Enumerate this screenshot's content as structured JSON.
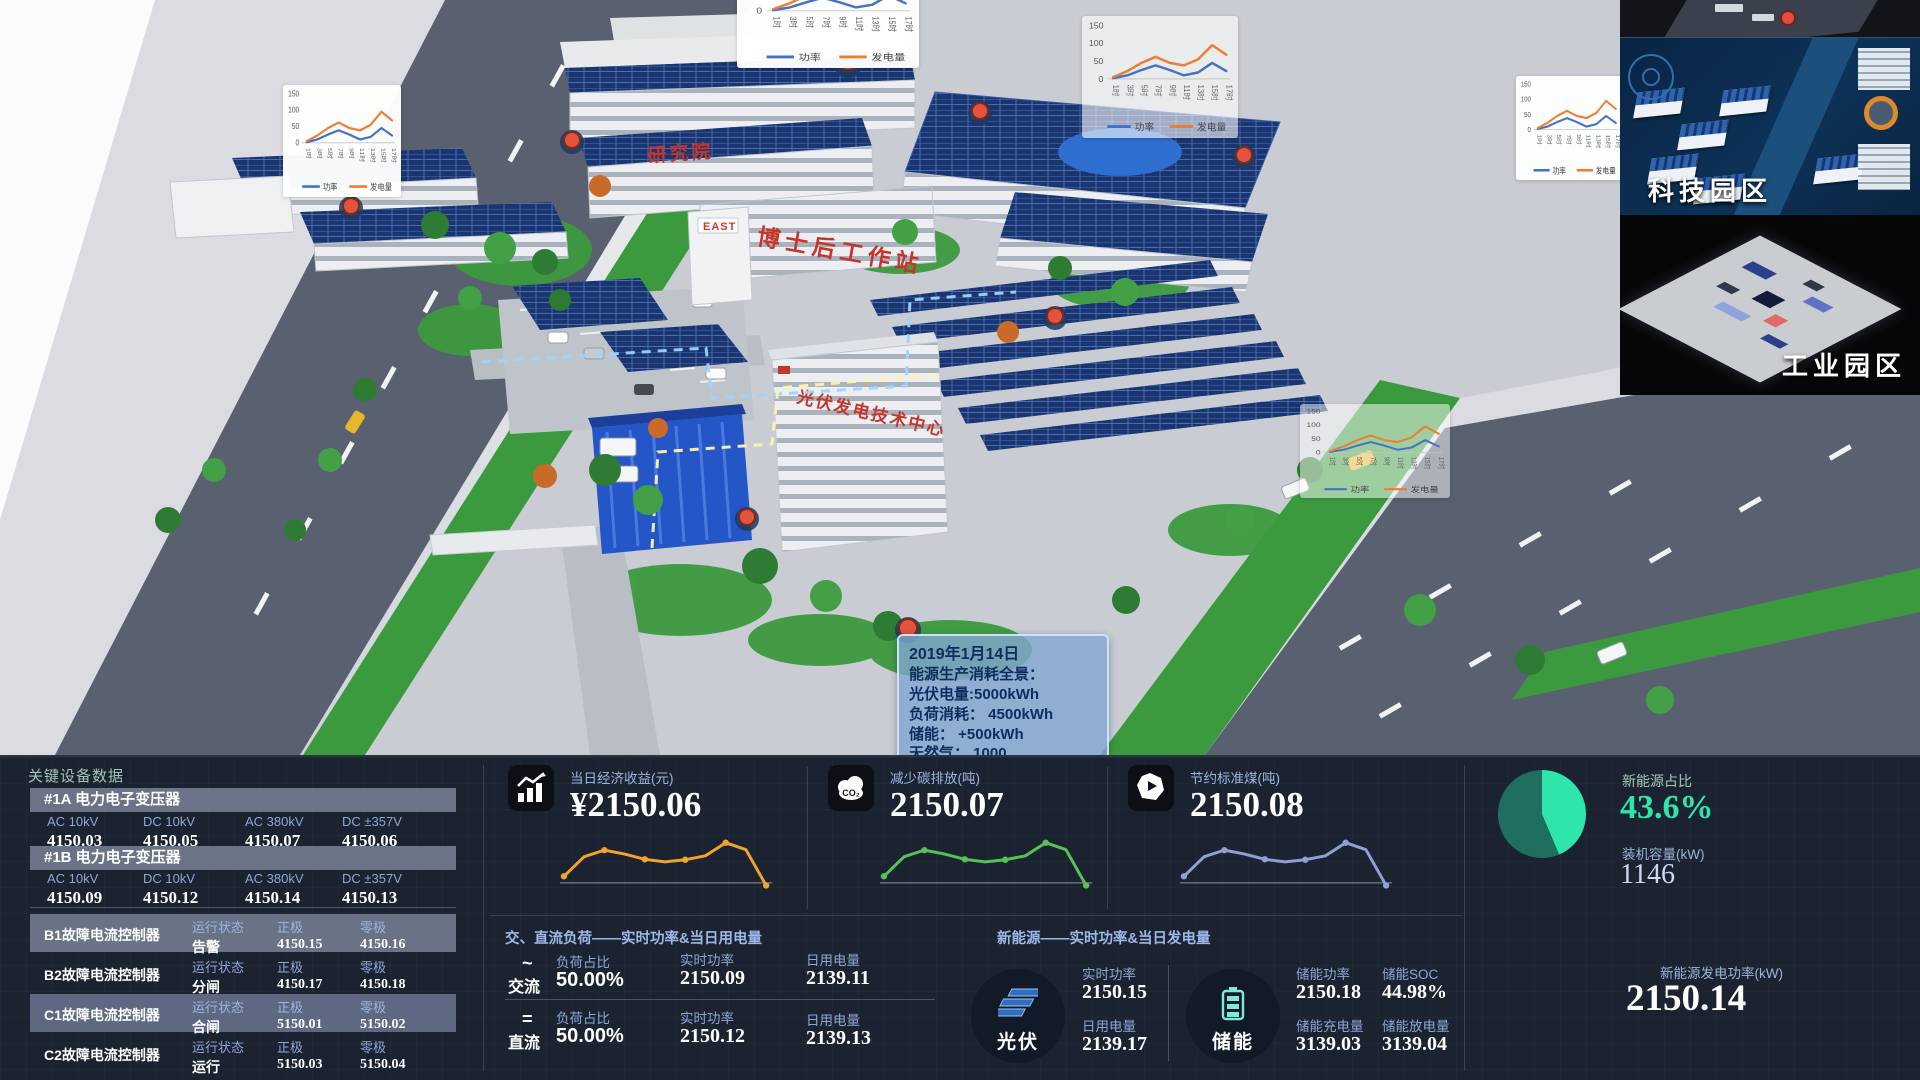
{
  "scene": {
    "buildings": {
      "institute": "研究院",
      "workstation": "博士后工作站",
      "east_logo": "EAST",
      "pv_center": "光伏发电技术中心"
    },
    "tooltip": {
      "date": "2019年1月14日",
      "title": "能源生产消耗全景：",
      "pv": "光伏电量:5000kWh",
      "load": "负荷消耗： 4500kWh",
      "storage": "储能： +500kWh",
      "gas": "天然气：  1000"
    },
    "mini_chart": {
      "type": "line",
      "yticks": [
        150,
        100,
        50,
        0
      ],
      "x": [
        "1时",
        "3时",
        "5时",
        "7时",
        "9时",
        "11时",
        "13时",
        "15时",
        "17时"
      ],
      "series": [
        {
          "name": "功率",
          "color": "#4472c4",
          "values": [
            2,
            10,
            25,
            38,
            25,
            10,
            18,
            45,
            22
          ]
        },
        {
          "name": "发电量",
          "color": "#ed7d31",
          "values": [
            5,
            22,
            45,
            62,
            45,
            38,
            55,
            95,
            68
          ]
        }
      ]
    }
  },
  "minimap": {
    "tech_park_label": "科技园区",
    "industrial_park_label": "工业园区"
  },
  "dashboard": {
    "equipment": {
      "title": "关键设备数据",
      "transformers": [
        {
          "name": "#1A 电力电子变压器",
          "metrics": [
            {
              "label": "AC 10kV",
              "value": "4150.03"
            },
            {
              "label": "DC 10kV",
              "value": "4150.05"
            },
            {
              "label": "AC 380kV",
              "value": "4150.07"
            },
            {
              "label": "DC ±357V",
              "value": "4150.06"
            }
          ]
        },
        {
          "name": "#1B 电力电子变压器",
          "metrics": [
            {
              "label": "AC 10kV",
              "value": "4150.09"
            },
            {
              "label": "DC 10kV",
              "value": "4150.12"
            },
            {
              "label": "AC 380kV",
              "value": "4150.14"
            },
            {
              "label": "DC ±357V",
              "value": "4150.13"
            }
          ]
        }
      ],
      "controllers": [
        {
          "name": "B1故障电流控制器",
          "status_label": "运行状态",
          "status": "告警",
          "pos_label": "正极",
          "pos_value": "4150.15",
          "zero_label": "零极",
          "zero_value": "4150.16"
        },
        {
          "name": "B2故障电流控制器",
          "status_label": "运行状态",
          "status": "分闸",
          "pos_label": "正极",
          "pos_value": "4150.17",
          "zero_label": "零极",
          "zero_value": "4150.18"
        },
        {
          "name": "C1故障电流控制器",
          "status_label": "运行状态",
          "status": "合闸",
          "pos_label": "正极",
          "pos_value": "5150.01",
          "zero_label": "零极",
          "zero_value": "5150.02"
        },
        {
          "name": "C2故障电流控制器",
          "status_label": "运行状态",
          "status": "运行",
          "pos_label": "正极",
          "pos_value": "5150.03",
          "zero_label": "零极",
          "zero_value": "5150.04"
        }
      ]
    },
    "kpis": [
      {
        "icon": "bar-chart-icon",
        "label": "当日经济收益(元)",
        "value": "¥2150.06",
        "color": "#f0a32f",
        "spark": [
          15,
          60,
          75,
          66,
          54,
          48,
          53,
          62,
          92,
          76,
          -6
        ]
      },
      {
        "icon": "co2-cloud-icon",
        "label": "减少碳排放(吨)",
        "value": "2150.07",
        "color": "#57c157",
        "spark": [
          15,
          60,
          75,
          66,
          54,
          48,
          53,
          62,
          92,
          76,
          -6
        ]
      },
      {
        "icon": "coal-icon",
        "label": "节约标准煤(吨)",
        "value": "2150.08",
        "color": "#8f9fd6",
        "spark": [
          15,
          60,
          75,
          66,
          54,
          48,
          53,
          62,
          92,
          76,
          -6
        ]
      }
    ],
    "energy_ratio": {
      "label": "新能源占比",
      "value": "43.6%",
      "percent": 43.6,
      "color_main": "#2ee6ac",
      "color_rest": "#1e6f60",
      "capacity_label": "装机容量(kW)",
      "capacity_value": "1146"
    },
    "load_panel": {
      "title": "交、直流负荷——实时功率&当日用电量",
      "rows": [
        {
          "symbol": "~",
          "name": "交流",
          "ratio_label": "负荷占比",
          "ratio": "50.00%",
          "power_label": "实时功率",
          "power": "2150.09",
          "energy_label": "日用电量",
          "energy": "2139.11"
        },
        {
          "symbol": "=",
          "name": "直流",
          "ratio_label": "负荷占比",
          "ratio": "50.00%",
          "power_label": "实时功率",
          "power": "2150.12",
          "energy_label": "日用电量",
          "energy": "2139.13"
        }
      ]
    },
    "new_energy_panel": {
      "title": "新能源——实时功率&当日发电量",
      "pv": {
        "name": "光伏",
        "metrics": [
          {
            "label": "实时功率",
            "value": "2150.15"
          },
          {
            "label": "日用电量",
            "value": "2139.17"
          }
        ]
      },
      "storage": {
        "name": "储能",
        "metrics": [
          {
            "label": "储能功率",
            "value": "2150.18"
          },
          {
            "label": "储能SOC",
            "value": "44.98%"
          },
          {
            "label": "储能充电量",
            "value": "3139.03"
          },
          {
            "label": "储能放电量",
            "value": "3139.04"
          }
        ]
      }
    },
    "gen_power": {
      "label": "新能源发电功率(kW)",
      "value": "2150.14"
    }
  }
}
